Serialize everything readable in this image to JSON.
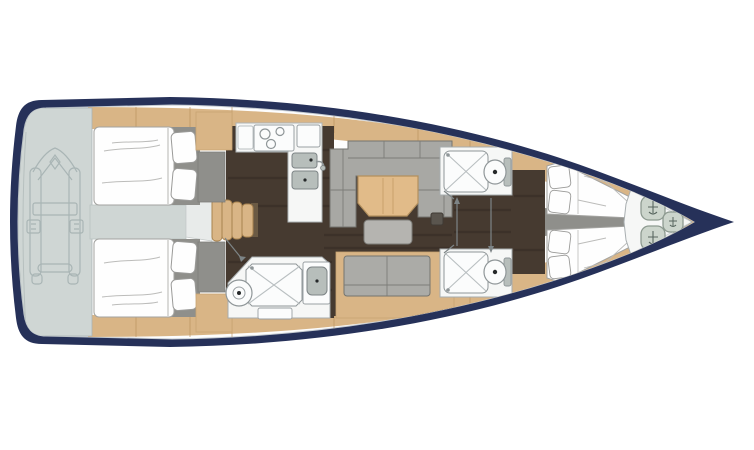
{
  "diagram": {
    "kind": "yacht-deck-floor-plan",
    "orientation": "bow-right",
    "rooms": [
      "stern-platform",
      "aft-cabin-port",
      "aft-cabin-starboard",
      "cockpit-passage",
      "companionway-stairs",
      "galley",
      "salon",
      "aft-head",
      "mid-head-port",
      "mid-head-starboard",
      "forward-cabin",
      "anchor-locker"
    ],
    "icons": [
      "dinghy-outline",
      "stove-burner-icon",
      "sink-icon",
      "shower-icon",
      "toilet-icon",
      "fender-coil-icon",
      "door-swing-arrow",
      "floor-hatch"
    ]
  },
  "colors": {
    "hull": "#263159",
    "deck": "#fdfdfd",
    "deckLine": "#c6ccd2",
    "wood": "#d9b586",
    "woodDark": "#b3905e",
    "floor": "#463a30",
    "platform": "#cfd6d4",
    "dinghyLine": "#a9b5b5",
    "sofa": "#a8a8a4",
    "sofaBack": "#9c9c98",
    "bench": "#ababa7",
    "stool": "#b5b4b0",
    "table": "#e1bb89",
    "bed": "#fefefe",
    "bedStroke": "#a3a3a0",
    "panel": "#8f8f8b",
    "fixture": "#f6f7f6",
    "fixtureStroke": "#9aa0a3",
    "basin": "#b7bebb",
    "coil": "#ccd5cc",
    "coilStroke": "#8d9a90",
    "hatch": "#5a554e"
  }
}
